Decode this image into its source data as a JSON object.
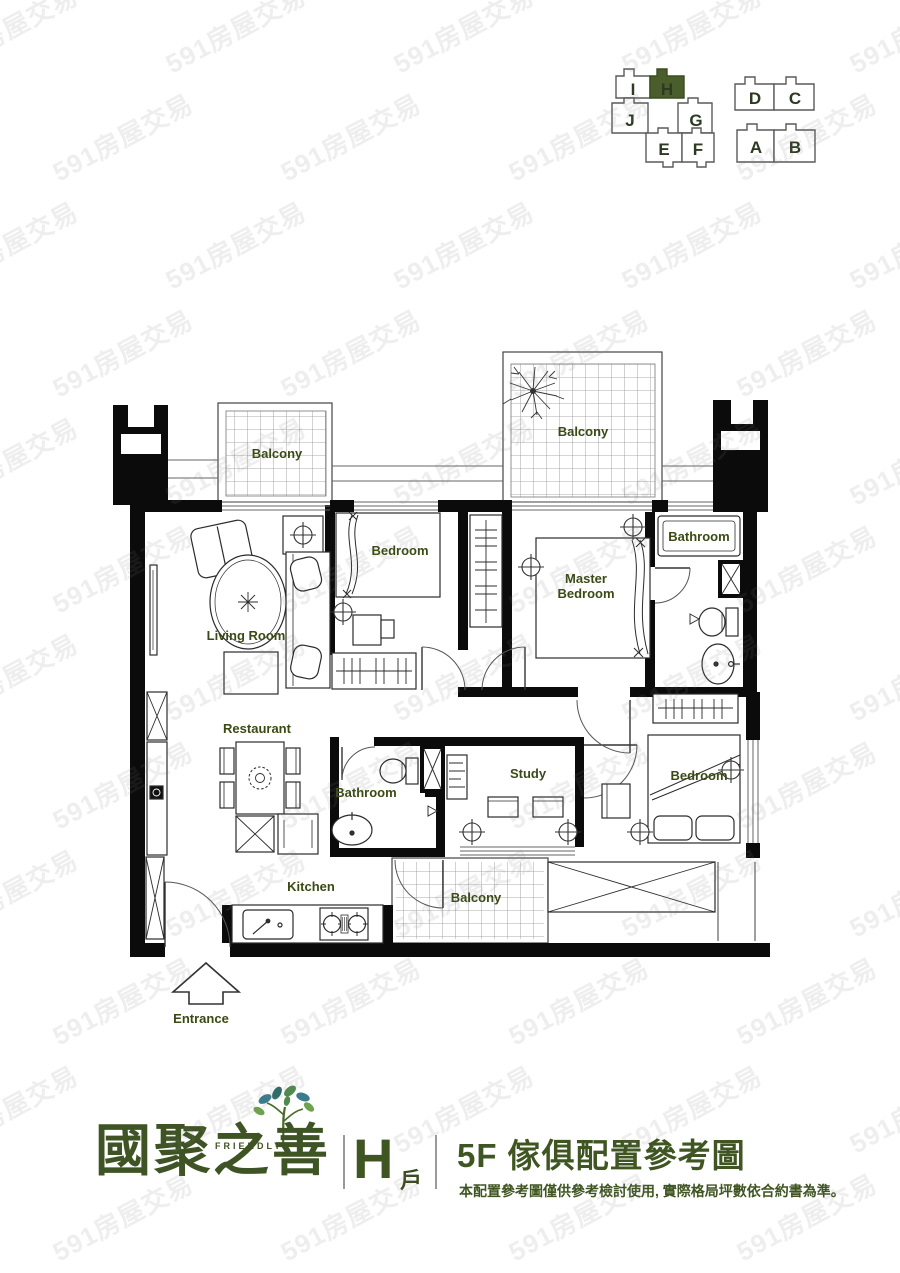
{
  "key_plan": {
    "highlight_color": "#4a5e2c",
    "left_units": [
      {
        "label": "I",
        "highlighted": false
      },
      {
        "label": "H",
        "highlighted": true
      },
      {
        "label": "J",
        "highlighted": false
      },
      {
        "label": "G",
        "highlighted": false
      },
      {
        "label": "E",
        "highlighted": false
      },
      {
        "label": "F",
        "highlighted": false
      }
    ],
    "right_units": [
      {
        "label": "D",
        "highlighted": false
      },
      {
        "label": "C",
        "highlighted": false
      },
      {
        "label": "A",
        "highlighted": false
      },
      {
        "label": "B",
        "highlighted": false
      }
    ]
  },
  "floor_plan": {
    "label_color": "#3a4a14",
    "rooms": {
      "balcony_top_left": "Balcony",
      "balcony_top_right": "Balcony",
      "bedroom_top": "Bedroom",
      "master_bedroom_line1": "Master",
      "master_bedroom_line2": "Bedroom",
      "bathroom_top": "Bathroom",
      "living_room": "Living Room",
      "restaurant": "Restaurant",
      "bathroom_middle": "Bathroom",
      "study": "Study",
      "bedroom_right": "Bedroom",
      "kitchen": "Kitchen",
      "balcony_bottom": "Balcony",
      "entrance": "Entrance"
    }
  },
  "footer": {
    "brand_name": "國聚之善",
    "brand_tagline": "FRIENDLY",
    "unit_letter": "H",
    "unit_suffix": "戶",
    "title": "5F 傢俱配置參考圖",
    "disclaimer": "本配置參考圖僅供參考檢討使用, 實際格局坪數依合約書為準。",
    "accent_color": "#3f5522"
  },
  "watermark": {
    "text": "591房屋交易"
  }
}
